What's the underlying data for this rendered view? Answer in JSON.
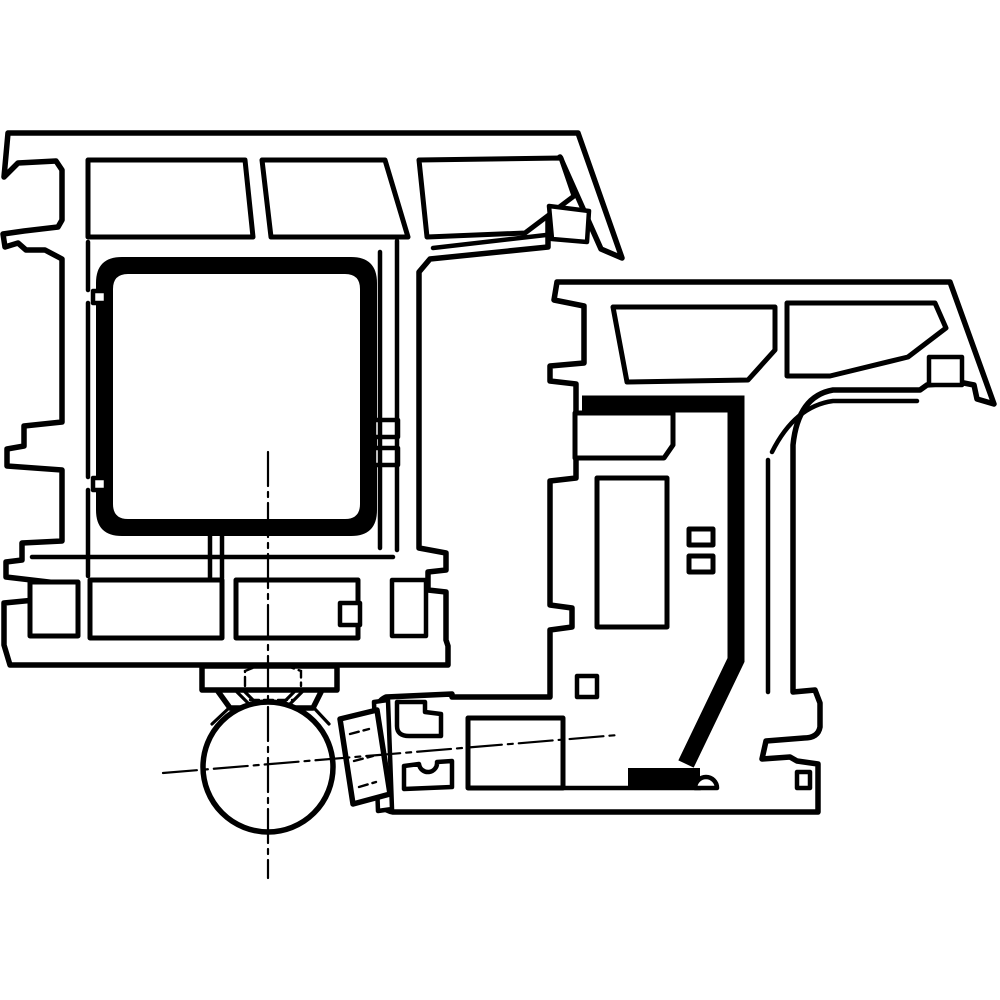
{
  "diagram": {
    "type": "technical-cross-section",
    "description": "Cross-section drawing of a window frame profile and sash profile with steel reinforcements and concealed hinge ball knuckle",
    "background_color": "#ffffff",
    "line_color": "#000000"
  },
  "geometry": {
    "frame_outline": "M 8 133 L 578 133 L 622 258 L 601 249 L 560 157 L 553 163 L 548 205 L 548 247 L 430 259 L 419 272 L 419 548 L 446 553 L 446 570 L 428 572 L 428 590 L 446 592 L 446 640 L 448 646 L 448 665 L 10 665 L 4 645 L 4 603 L 45 599 L 57 583 L 6 577 L 6 562 L 22 560 L 22 543 L 62 541 L 62 470 L 7 466 L 7 449 L 24 446 L 24 426 L 62 422 L 62 259 L 45 250 L 26 250 L 18 243 L 5 247 L 3 234 L 24 231 L 58 227 L 62 220 L 62 170 L 56 161 L 18 163 L 4 177 Z",
    "frame_chambers": "M 88 160 L 245 160 L 253 237 L 88 237 Z M 262 160 L 385 160 L 408 237 L 271 237 Z M 419 160 L 561 158 L 574 196 L 525 233 L 427 237 Z M 30 582 L 78 582 L 78 636 L 30 636 Z M 90 580 L 222 580 L 222 638 L 90 638 Z M 236 580 L 358 580 L 358 638 L 236 638 Z",
    "frame_steel_square": "M 122 257 L 351 257 Q 377 257 377 283 L 377 510 Q 377 536 351 536 L 122 536 Q 96 536 96 510 L 96 283 Q 96 257 122 257 Z M 128 274 L 345 274 Q 360 274 360 289 L 360 504 Q 360 519 345 519 L 128 519 Q 113 519 113 504 L 113 289 Q 113 274 128 274 Z",
    "frame_overlays": "M 549 206 L 589 211 L 587 242 L 552 239 Z M 374 420 L 398 420 L 398 437 L 374 437 Z M 374 448 L 398 448 L 398 465 L 374 465 Z M 340 603 L 360 603 L 360 625 L 340 625 Z M 392 580 L 426 580 L 426 636 L 392 636 Z M 93 291 L 106 291 L 106 303 L 93 303 Z M 93 478 L 106 478 L 106 490 L 93 490 Z",
    "frame_inner_lines": "M 88 242 L 88 290 M 88 303 L 88 477 M 88 490 L 88 576 M 380 252 L 380 548 M 397 241 L 397 550 M 546 235 L 433 248 M 32 557 L 393 557 M 210 536 L 210 578 M 222 536 L 222 578",
    "sash_outline": "M 557 282 L 950 282 L 994 404 L 977 399 L 974 385 L 959 382 L 927 385 L 920 390 L 833 390 Q 798 396 793 445 L 793 692 L 815 690 L 820 703 L 820 727 Q 818 738 804 738 L 766 741 L 762 759 L 790 757 L 797 761 L 818 764 L 818 812 L 393 812 Q 381 810 380 798 L 377 712 Q 377 701 386 697 L 452 694 L 452 697 L 550 697 L 550 630 L 572 627 L 572 608 L 550 605 L 550 481 L 576 478 L 576 384 L 550 381 L 550 366 L 584 363 L 584 306 L 554 300 Z",
    "sash_chambers": "M 613 307 L 775 307 L 775 350 L 748 380 L 627 382 Z M 787 303 L 935 303 L 946 328 L 908 357 L 830 376 L 787 376 Z M 575 413 L 673 413 L 673 445 L 664 458 L 575 458 Z M 597 478 L 667 478 L 667 627 L 597 627 Z M 689 529 L 713 529 L 713 545 L 689 545 Z M 689 556 L 713 556 L 713 572 L 689 572 Z M 468 718 L 563 718 L 563 788 L 468 788 Z",
    "sash_steel_channel": "M 582 404 L 736 404 L 736 660 L 686 764",
    "sash_steel_bar": "M 628 768 L 700 768 L 700 788 L 628 788 Z",
    "sash_inner_lines": "M 768 460 L 768 692 M 833 401 Q 795 406 772 452 M 833 401 L 917 401 M 560 788 L 700 788",
    "sash_overlays": "M 929 357 L 962 357 L 962 385 L 929 385 Z M 577 676 L 597 676 L 597 697 L 577 697 Z M 695 788 A 11 11 0 1 1 717 788 Z M 797 772 L 810 772 L 810 788 L 797 788 Z M 397 702 L 397 726 Q 397 736 409 736 L 441 736 L 441 714 L 425 712 L 425 702 Z M 404 789 L 404 766 L 419 764 A 9 9 0 0 0 437 762 L 452 761 L 452 787 Z",
    "hinge_block": "M 202 666 L 337 666 L 337 690 L 202 690 Z M 217 690 L 322 690 L 313 708 L 230 708 Z",
    "hinge_solid_details": "M 229 708 L 212 724 M 314 708 L 329 724 M 237 692 L 251 706 M 245 692 L 259 706 M 302 692 L 288 706 M 294 692 L 280 706 M 343 729 L 350 741",
    "hinge_ball": "M 203 767 A 65 65 0 1 0 333 767 A 65 65 0 1 0 203 767 Z",
    "hinge_plate": "M 374 702 L 388 700 L 392 809 L 378 811 Z",
    "hinge_clamp": "M 340 719 L 377 710 L 390 794 L 353 804 Z",
    "hidden_dashed": "M 245 686 L 245 671 L 255 667 L 290 667 L 301 671 L 301 686 M 250 700 L 293 700 M 350 734 L 369 729 M 354 761 L 373 756 M 359 787 L 376 782",
    "centerline_vertical": "M 268 452 L 268 878",
    "centerline_diagonal": "M 163 773 L 618 735"
  }
}
